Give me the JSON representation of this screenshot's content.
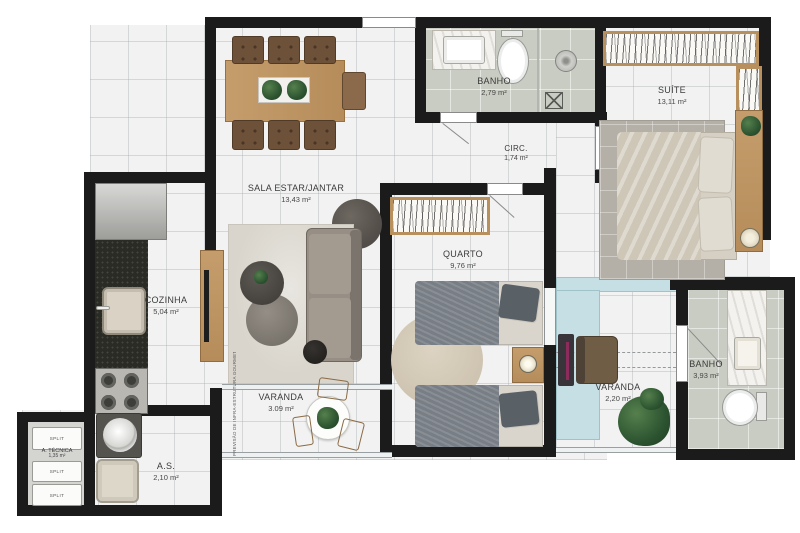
{
  "plan": {
    "title": "apartment-floor-plan",
    "rooms": [
      {
        "id": "sala",
        "name": "SALA ESTAR/JANTAR",
        "area": "13,43 m²"
      },
      {
        "id": "banho_social",
        "name": "BANHO",
        "area": "2,79 m²"
      },
      {
        "id": "suite",
        "name": "SUÍTE",
        "area": "13,11 m²"
      },
      {
        "id": "circ",
        "name": "CIRC.",
        "area": "1,74 m²"
      },
      {
        "id": "quarto",
        "name": "QUARTO",
        "area": "9,76 m²"
      },
      {
        "id": "cozinha",
        "name": "COZINHA",
        "area": "5,04 m²"
      },
      {
        "id": "varanda_gourmet",
        "name": "VARANDA",
        "area": "3.09 m²"
      },
      {
        "id": "varanda",
        "name": "VARANDA",
        "area": "2,20 m²"
      },
      {
        "id": "banho_suite",
        "name": "BANHO",
        "area": "3,93 m²"
      },
      {
        "id": "area_servico",
        "name": "A.S.",
        "area": "2,10 m²"
      },
      {
        "id": "area_tecnica",
        "name": "A. TÉCNICA",
        "area": "1,35 m²"
      }
    ],
    "equipment": {
      "split_label": "SPLIT"
    },
    "notes": {
      "varanda_note": "PREVISÃO DE INFRA-ESTRUTURA GOURMET"
    },
    "colors": {
      "wall": "#1b1b1b",
      "floor_tile": "#f1f2f1",
      "bath_floor": "#c9ccc2",
      "tech_floor": "#d4d4d1",
      "wood": "#bb9161",
      "glass": "#c5dfe4",
      "label_text": "#3b3b3b"
    }
  }
}
